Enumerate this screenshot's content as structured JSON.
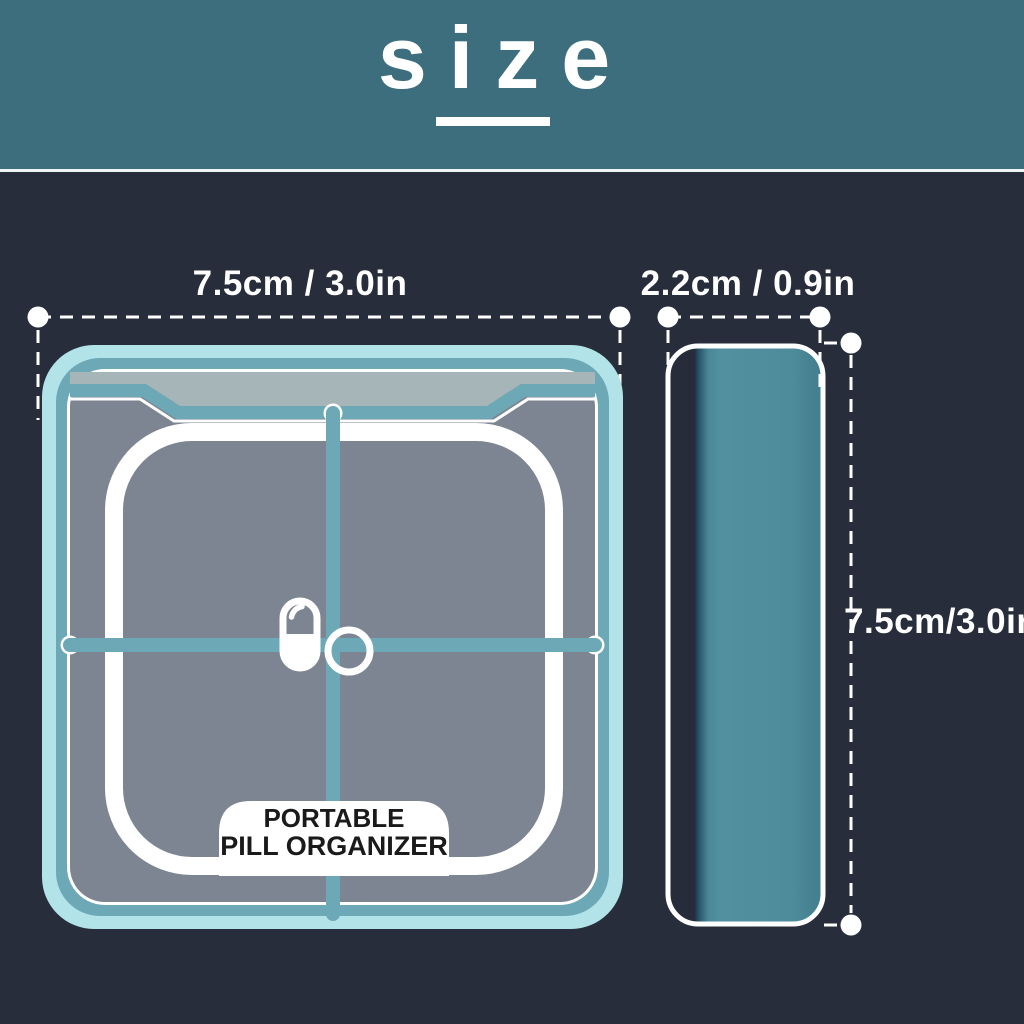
{
  "title": "size",
  "colors": {
    "header_bg": "#3d6e7e",
    "background": "#272d3b",
    "accent_cyan": "#b2e3e8",
    "accent_teal": "#6da8b6",
    "lid_gray": "#7d8492",
    "lid_top_gray": "#a6b5b8",
    "side_body_teal": "#4f8d9c",
    "white": "#ffffff",
    "label_text": "#1a1a1a"
  },
  "top_view": {
    "width_label": "7.5cm / 3.0in",
    "product_label_line1": "PORTABLE",
    "product_label_line2": "PILL ORGANIZER"
  },
  "side_view": {
    "width_label": "2.2cm / 0.9in",
    "height_label": "7.5cm/3.0in"
  }
}
